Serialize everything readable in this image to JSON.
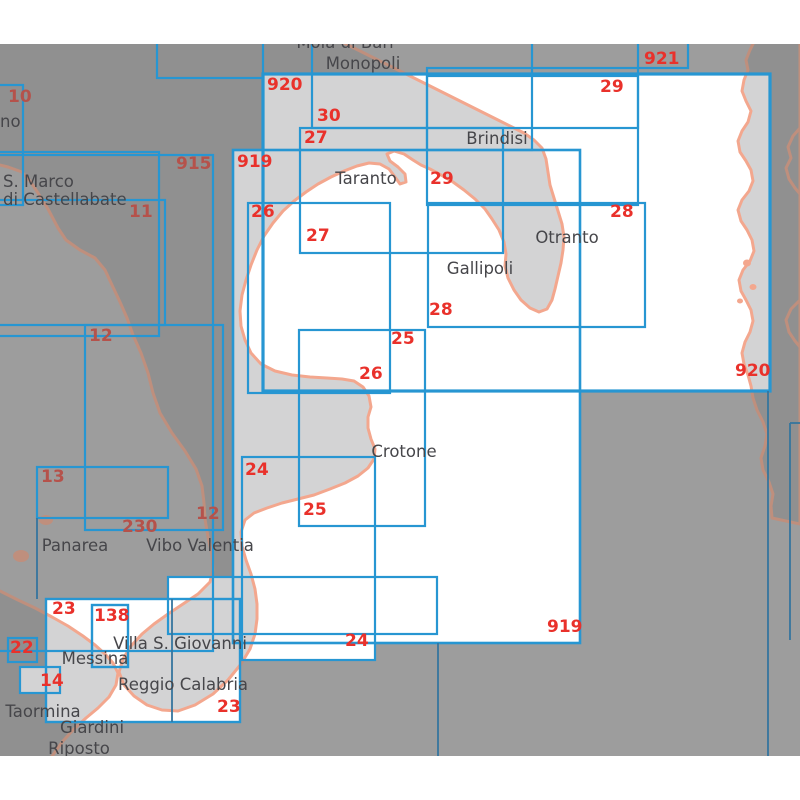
{
  "map": {
    "type": "nautical-chart-index",
    "area_top": 44,
    "area_bottom": 756,
    "colors": {
      "page_bg": "#ffffff",
      "sea_outside": "#9d9d9d",
      "land_outside": "#909090",
      "coast_outside": "#bf8f7d",
      "chart_area_fill": "#ffffff",
      "land_inside": "#d3d3d4",
      "coast_inside": "#f3a78e",
      "box_blue": "#2796d2",
      "line_blue_dark": "#35759e",
      "number_red": "#e9312b",
      "number_red_dim": "#b5524b",
      "place_text": "#46464a"
    }
  },
  "chart_boxes": [
    {
      "id": "920",
      "x1": 263,
      "y1": 74,
      "x2": 770,
      "y2": 391,
      "bright": true,
      "sw": 3.2
    },
    {
      "id": "921",
      "x1": 532,
      "y1": 16,
      "x2": 688,
      "y2": 68,
      "bright": false,
      "sw": 2.2
    },
    {
      "id": "",
      "x1": 157,
      "y1": 16,
      "x2": 263,
      "y2": 78,
      "bright": false,
      "sw": 2.2
    },
    {
      "id": "30",
      "x1": 312,
      "y1": 16,
      "x2": 638,
      "y2": 128,
      "bright": false,
      "sw": 2.2
    },
    {
      "id": "29",
      "x1": 427,
      "y1": 76,
      "x2": 638,
      "y2": 205,
      "bright": true,
      "sw": 2.2
    },
    {
      "id": "",
      "x1": 427,
      "y1": 68,
      "x2": 532,
      "y2": 150,
      "bright": false,
      "sw": 2.2
    },
    {
      "id": "27",
      "x1": 300,
      "y1": 128,
      "x2": 503,
      "y2": 253,
      "bright": true,
      "sw": 2.2
    },
    {
      "id": "28",
      "x1": 428,
      "y1": 203,
      "x2": 645,
      "y2": 327,
      "bright": true,
      "sw": 2.2
    },
    {
      "id": "919",
      "x1": 233,
      "y1": 150,
      "x2": 580,
      "y2": 643,
      "bright": true,
      "sw": 2.6
    },
    {
      "id": "26",
      "x1": 248,
      "y1": 203,
      "x2": 390,
      "y2": 393,
      "bright": true,
      "sw": 2.2
    },
    {
      "id": "25",
      "x1": 299,
      "y1": 330,
      "x2": 425,
      "y2": 526,
      "bright": true,
      "sw": 2.2
    },
    {
      "id": "24",
      "x1": 242,
      "y1": 457,
      "x2": 375,
      "y2": 660,
      "bright": true,
      "sw": 2.2
    },
    {
      "id": "915",
      "x1": -25,
      "y1": 152,
      "x2": 159,
      "y2": 336,
      "bright": false,
      "sw": 2.2
    },
    {
      "id": "11",
      "x1": -25,
      "y1": 200,
      "x2": 165,
      "y2": 325,
      "bright": false,
      "sw": 2.2
    },
    {
      "id": "12",
      "x1": 85,
      "y1": 325,
      "x2": 223,
      "y2": 530,
      "bright": false,
      "sw": 2.2
    },
    {
      "id": "230",
      "x1": -25,
      "y1": 155,
      "x2": 213,
      "y2": 651,
      "bright": false,
      "sw": 2.2
    },
    {
      "id": "10",
      "x1": -25,
      "y1": 85,
      "x2": 23,
      "y2": 205,
      "bright": false,
      "sw": 2.2
    },
    {
      "id": "13",
      "x1": 37,
      "y1": 467,
      "x2": 168,
      "y2": 518,
      "bright": false,
      "sw": 2.2
    },
    {
      "id": "23",
      "x1": 46,
      "y1": 599,
      "x2": 240,
      "y2": 722,
      "bright": true,
      "sw": 2.4
    },
    {
      "id": "138",
      "x1": 92,
      "y1": 605,
      "x2": 128,
      "y2": 667,
      "bright": true,
      "sw": 2.4
    },
    {
      "id": "22",
      "x1": 8,
      "y1": 638,
      "x2": 37,
      "y2": 662,
      "bright": false,
      "sw": 2.2
    },
    {
      "id": "14",
      "x1": 20,
      "y1": 667,
      "x2": 60,
      "y2": 693,
      "bright": true,
      "sw": 2.2
    },
    {
      "id": "",
      "x1": 168,
      "y1": 577,
      "x2": 437,
      "y2": 634,
      "bright": true,
      "sw": 2.2
    }
  ],
  "boundary_lines": [
    {
      "x1": 768,
      "y1": 391,
      "x2": 768,
      "y2": 756
    },
    {
      "x1": 790,
      "y1": 423,
      "x2": 790,
      "y2": 640
    },
    {
      "x1": 790,
      "y1": 423,
      "x2": 800,
      "y2": 423
    },
    {
      "x1": 438,
      "y1": 643,
      "x2": 438,
      "y2": 756
    },
    {
      "x1": 172,
      "y1": 599,
      "x2": 172,
      "y2": 722
    },
    {
      "x1": 37,
      "y1": 518,
      "x2": 37,
      "y2": 599
    }
  ],
  "chart_numbers": [
    {
      "text": "920",
      "x": 267,
      "y": 90,
      "dim": false
    },
    {
      "text": "920",
      "x": 735,
      "y": 376,
      "dim": false
    },
    {
      "text": "921",
      "x": 644,
      "y": 64,
      "dim": false
    },
    {
      "text": "30",
      "x": 317,
      "y": 121,
      "dim": false
    },
    {
      "text": "29",
      "x": 600,
      "y": 92,
      "dim": false
    },
    {
      "text": "29",
      "x": 430,
      "y": 184,
      "dim": false
    },
    {
      "text": "27",
      "x": 304,
      "y": 143,
      "dim": false
    },
    {
      "text": "27",
      "x": 306,
      "y": 241,
      "dim": false
    },
    {
      "text": "28",
      "x": 610,
      "y": 217,
      "dim": false
    },
    {
      "text": "28",
      "x": 429,
      "y": 315,
      "dim": false
    },
    {
      "text": "919",
      "x": 237,
      "y": 167,
      "dim": false
    },
    {
      "text": "919",
      "x": 547,
      "y": 632,
      "dim": false
    },
    {
      "text": "26",
      "x": 251,
      "y": 217,
      "dim": false
    },
    {
      "text": "26",
      "x": 359,
      "y": 379,
      "dim": false
    },
    {
      "text": "25",
      "x": 391,
      "y": 344,
      "dim": false
    },
    {
      "text": "25",
      "x": 303,
      "y": 515,
      "dim": false
    },
    {
      "text": "24",
      "x": 245,
      "y": 475,
      "dim": false
    },
    {
      "text": "24",
      "x": 345,
      "y": 646,
      "dim": false
    },
    {
      "text": "915",
      "x": 176,
      "y": 169,
      "dim": true
    },
    {
      "text": "10",
      "x": 8,
      "y": 102,
      "dim": true
    },
    {
      "text": "11",
      "x": 129,
      "y": 217,
      "dim": true
    },
    {
      "text": "12",
      "x": 89,
      "y": 341,
      "dim": true
    },
    {
      "text": "12",
      "x": 196,
      "y": 519,
      "dim": true
    },
    {
      "text": "13",
      "x": 41,
      "y": 482,
      "dim": true
    },
    {
      "text": "230",
      "x": 122,
      "y": 532,
      "dim": true
    },
    {
      "text": "23",
      "x": 52,
      "y": 614,
      "dim": false
    },
    {
      "text": "23",
      "x": 217,
      "y": 712,
      "dim": false
    },
    {
      "text": "138",
      "x": 94,
      "y": 621,
      "dim": false
    },
    {
      "text": "22",
      "x": 10,
      "y": 653,
      "dim": false
    },
    {
      "text": "14",
      "x": 40,
      "y": 686,
      "dim": false
    }
  ],
  "place_labels": [
    {
      "text": "Mola di Bari",
      "x": 345,
      "y": 48,
      "anchor": "middle"
    },
    {
      "text": "Monopoli",
      "x": 363,
      "y": 69,
      "anchor": "middle"
    },
    {
      "text": "Brindisi",
      "x": 497,
      "y": 144,
      "anchor": "middle"
    },
    {
      "text": "Taranto",
      "x": 366,
      "y": 184,
      "anchor": "middle"
    },
    {
      "text": "Otranto",
      "x": 567,
      "y": 243,
      "anchor": "middle"
    },
    {
      "text": "Gallipoli",
      "x": 480,
      "y": 274,
      "anchor": "middle"
    },
    {
      "text": "Crotone",
      "x": 404,
      "y": 457,
      "anchor": "middle"
    },
    {
      "text": "Panarea",
      "x": 75,
      "y": 551,
      "anchor": "middle"
    },
    {
      "text": "Vibo Valentia",
      "x": 200,
      "y": 551,
      "anchor": "middle"
    },
    {
      "text": "S. Marco",
      "x": 3,
      "y": 187,
      "anchor": "start"
    },
    {
      "text": "di Castellabate",
      "x": 3,
      "y": 205,
      "anchor": "start"
    },
    {
      "text": "no",
      "x": 0,
      "y": 127,
      "anchor": "start"
    },
    {
      "text": "Villa S. Giovanni",
      "x": 180,
      "y": 649,
      "anchor": "middle"
    },
    {
      "text": "Messina",
      "x": 95,
      "y": 664,
      "anchor": "middle"
    },
    {
      "text": "Reggio Calabria",
      "x": 183,
      "y": 690,
      "anchor": "middle"
    },
    {
      "text": "Taormina",
      "x": 43,
      "y": 717,
      "anchor": "middle"
    },
    {
      "text": "Giardini",
      "x": 92,
      "y": 733,
      "anchor": "middle"
    },
    {
      "text": "Riposto",
      "x": 79,
      "y": 754,
      "anchor": "middle"
    }
  ]
}
